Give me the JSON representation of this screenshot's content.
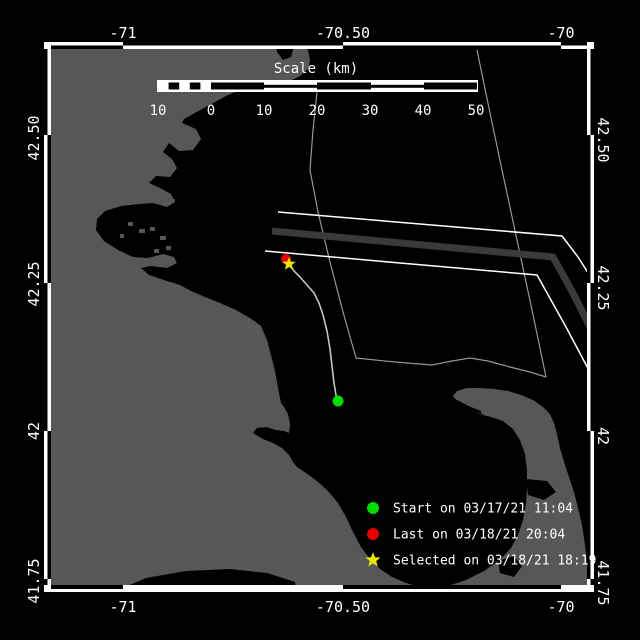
{
  "axis": {
    "top": [
      "-71",
      "-70.50",
      "-70"
    ],
    "bottom": [
      "-71",
      "-70.50",
      "-70"
    ],
    "left": [
      "42.50",
      "42.25",
      "42",
      "41.75"
    ],
    "right": [
      "42.50",
      "42.25",
      "42",
      "41.75"
    ]
  },
  "scale_bar": {
    "title": "Scale (km)",
    "ticks": [
      "10",
      "0",
      "10",
      "20",
      "30",
      "40",
      "50"
    ]
  },
  "legend": {
    "items": [
      {
        "marker": "start-dot",
        "color": "#00dc00",
        "label": "Start on 03/17/21 11:04"
      },
      {
        "marker": "last-dot",
        "color": "#e60000",
        "label": "Last on 03/18/21 20:04"
      },
      {
        "marker": "selected-star",
        "color": "#ebe300",
        "label": "Selected on 03/18/21 18:19"
      }
    ]
  },
  "colors": {
    "water": "#000000",
    "land": "#575757",
    "frame": "#ffffff",
    "track": "#c4c4c4",
    "boundary_line": "#969696",
    "separation_zone": "#3a3a3a",
    "start": "#00dc00",
    "last": "#e60000",
    "selected": "#ebe300"
  }
}
